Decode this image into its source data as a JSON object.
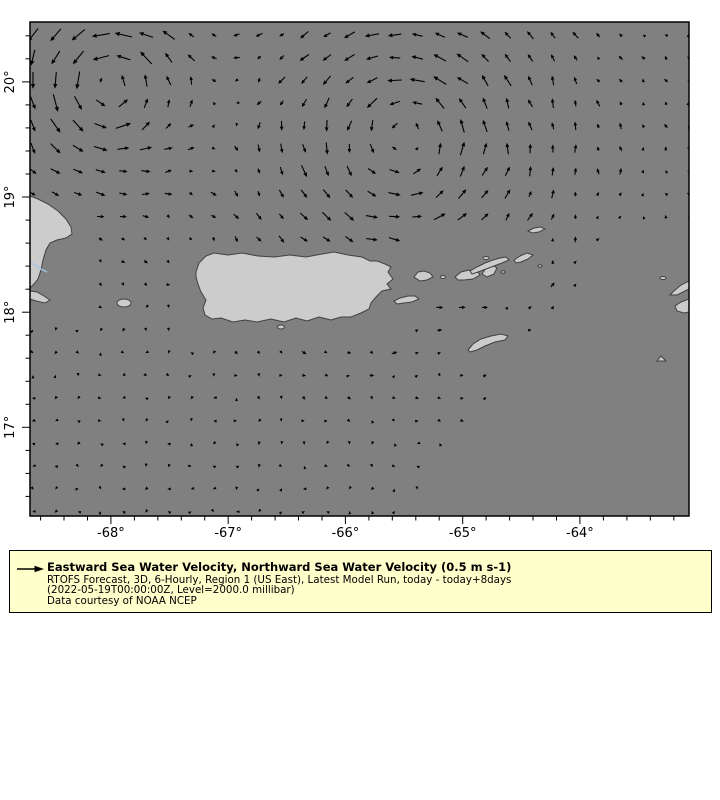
{
  "map": {
    "ocean_color": "#808080",
    "land_color": "#cccccc",
    "coast_color": "#404040",
    "river_color": "#9fc5e8",
    "arrow_color": "#000000",
    "axis_color": "#000000"
  },
  "chart_data": {
    "type": "quiver",
    "projection": "lonlat",
    "lon_range": [
      -68.69,
      -63.07
    ],
    "lat_range": [
      16.23,
      20.52
    ],
    "x_ticks": {
      "major": [
        -68,
        -67,
        -66,
        -65,
        -64
      ],
      "labels": [
        "-68°",
        "-67°",
        "-66°",
        "-65°",
        "-64°"
      ],
      "minor_step": 0.2
    },
    "y_ticks": {
      "major": [
        17,
        18,
        19,
        20
      ],
      "labels": [
        "17°",
        "18°",
        "19°",
        "20°"
      ],
      "minor_step": 0.2
    },
    "grid": {
      "origin_px": [
        33,
        35
      ],
      "dx": 22.6,
      "dy": 22.7,
      "cols": 30,
      "rows": 22
    },
    "scale_px_per_ms": 52,
    "background_flow": {
      "u": -0.022,
      "v": -0.006
    },
    "noise_amplitude": 0.045,
    "eddies": [
      {
        "center_lon": -68.05,
        "center_lat": 20.0,
        "rotation": "cyclonic",
        "peak_speed": 0.3,
        "core_radius_deg": 0.38
      },
      {
        "center_lon": -65.5,
        "center_lat": 19.55,
        "rotation": "cyclonic",
        "peak_speed": 0.24,
        "core_radius_deg": 0.6
      }
    ],
    "data_boundary": {
      "x0": 618,
      "y0": 232,
      "slope": -0.779,
      "min_y": 226
    },
    "reference_vector": {
      "speed_ms": 0.5,
      "label": "0.5 m s-1"
    }
  },
  "land": {
    "polygons": [
      {
        "name": "hispaniola-east-coast",
        "points": [
          [
            30,
            196
          ],
          [
            38,
            199
          ],
          [
            48,
            204
          ],
          [
            58,
            211
          ],
          [
            66,
            219
          ],
          [
            71,
            227
          ],
          [
            72,
            234
          ],
          [
            66,
            238
          ],
          [
            57,
            240
          ],
          [
            50,
            243
          ],
          [
            46,
            250
          ],
          [
            43,
            260
          ],
          [
            41,
            270
          ],
          [
            38,
            279
          ],
          [
            34,
            284
          ],
          [
            30,
            288
          ]
        ]
      },
      {
        "name": "hispaniola-south-peninsula",
        "points": [
          [
            30,
            291
          ],
          [
            37,
            292
          ],
          [
            44,
            296
          ],
          [
            50,
            300
          ],
          [
            45,
            303
          ],
          [
            36,
            301
          ],
          [
            30,
            299
          ]
        ]
      },
      {
        "name": "puerto-rico",
        "points": [
          [
            196,
            272
          ],
          [
            199,
            263
          ],
          [
            206,
            256
          ],
          [
            214,
            253
          ],
          [
            228,
            255
          ],
          [
            242,
            253
          ],
          [
            258,
            256
          ],
          [
            274,
            257
          ],
          [
            290,
            255
          ],
          [
            306,
            257
          ],
          [
            322,
            254
          ],
          [
            334,
            252
          ],
          [
            348,
            255
          ],
          [
            362,
            257
          ],
          [
            370,
            261
          ],
          [
            377,
            261
          ],
          [
            385,
            264
          ],
          [
            391,
            267
          ],
          [
            388,
            272
          ],
          [
            393,
            279
          ],
          [
            387,
            284
          ],
          [
            391,
            289
          ],
          [
            382,
            291
          ],
          [
            376,
            297
          ],
          [
            371,
            303
          ],
          [
            369,
            309
          ],
          [
            361,
            313
          ],
          [
            351,
            317
          ],
          [
            341,
            317
          ],
          [
            331,
            320
          ],
          [
            319,
            317
          ],
          [
            307,
            321
          ],
          [
            296,
            318
          ],
          [
            284,
            322
          ],
          [
            271,
            319
          ],
          [
            257,
            322
          ],
          [
            245,
            320
          ],
          [
            233,
            322
          ],
          [
            221,
            318
          ],
          [
            212,
            319
          ],
          [
            205,
            315
          ],
          [
            203,
            308
          ],
          [
            206,
            300
          ],
          [
            201,
            292
          ],
          [
            198,
            284
          ],
          [
            196,
            277
          ]
        ]
      },
      {
        "name": "vieques",
        "points": [
          [
            394,
            301
          ],
          [
            400,
            298
          ],
          [
            408,
            296
          ],
          [
            415,
            296
          ],
          [
            419,
            299
          ],
          [
            412,
            302
          ],
          [
            404,
            303
          ],
          [
            397,
            304
          ]
        ]
      },
      {
        "name": "culebra",
        "points": [
          [
            414,
            277
          ],
          [
            418,
            272
          ],
          [
            424,
            271
          ],
          [
            430,
            273
          ],
          [
            433,
            277
          ],
          [
            427,
            280
          ],
          [
            420,
            281
          ]
        ]
      },
      {
        "name": "st-thomas",
        "points": [
          [
            455,
            277
          ],
          [
            461,
            272
          ],
          [
            469,
            270
          ],
          [
            477,
            271
          ],
          [
            480,
            275
          ],
          [
            473,
            279
          ],
          [
            464,
            280
          ],
          [
            458,
            280
          ]
        ]
      },
      {
        "name": "st-john",
        "points": [
          [
            482,
            274
          ],
          [
            486,
            268
          ],
          [
            492,
            265
          ],
          [
            497,
            268
          ],
          [
            494,
            274
          ],
          [
            487,
            277
          ]
        ]
      },
      {
        "name": "tortola-chain",
        "points": [
          [
            470,
            271
          ],
          [
            477,
            267
          ],
          [
            485,
            263
          ],
          [
            493,
            260
          ],
          [
            500,
            258
          ],
          [
            506,
            257
          ],
          [
            509,
            260
          ],
          [
            502,
            263
          ],
          [
            494,
            266
          ],
          [
            486,
            269
          ],
          [
            478,
            272
          ],
          [
            472,
            274
          ]
        ]
      },
      {
        "name": "virgin-gorda",
        "points": [
          [
            514,
            260
          ],
          [
            520,
            256
          ],
          [
            527,
            253
          ],
          [
            533,
            255
          ],
          [
            528,
            259
          ],
          [
            521,
            262
          ],
          [
            516,
            263
          ]
        ]
      },
      {
        "name": "anegada",
        "points": [
          [
            528,
            231
          ],
          [
            534,
            228
          ],
          [
            541,
            227
          ],
          [
            545,
            229
          ],
          [
            539,
            232
          ],
          [
            532,
            233
          ]
        ]
      },
      {
        "name": "st-croix",
        "points": [
          [
            468,
            350
          ],
          [
            473,
            344
          ],
          [
            481,
            339
          ],
          [
            491,
            336
          ],
          [
            501,
            334
          ],
          [
            508,
            336
          ],
          [
            505,
            340
          ],
          [
            495,
            342
          ],
          [
            485,
            346
          ],
          [
            477,
            350
          ],
          [
            470,
            352
          ]
        ]
      },
      {
        "name": "anguilla-edge",
        "points": [
          [
            689,
            281
          ],
          [
            681,
            285
          ],
          [
            674,
            291
          ],
          [
            670,
            295
          ],
          [
            677,
            295
          ],
          [
            685,
            291
          ],
          [
            689,
            289
          ]
        ]
      },
      {
        "name": "st-martin-edge",
        "points": [
          [
            689,
            299
          ],
          [
            681,
            302
          ],
          [
            675,
            306
          ],
          [
            677,
            311
          ],
          [
            684,
            313
          ],
          [
            689,
            312
          ]
        ]
      },
      {
        "name": "saba",
        "points": [
          [
            657,
            361
          ],
          [
            661,
            356
          ],
          [
            666,
            361
          ]
        ]
      }
    ],
    "ellipses": [
      {
        "name": "mona-island",
        "cx": 124,
        "cy": 303,
        "rx": 7,
        "ry": 4
      },
      {
        "name": "caja-de-muertos",
        "cx": 281,
        "cy": 327,
        "rx": 3.5,
        "ry": 2
      },
      {
        "name": "culebrita",
        "cx": 443,
        "cy": 277,
        "rx": 2.5,
        "ry": 1.5
      },
      {
        "name": "jost-van-dyke",
        "cx": 486,
        "cy": 258,
        "rx": 3,
        "ry": 1.5
      },
      {
        "name": "islet-a",
        "cx": 503,
        "cy": 272,
        "rx": 2,
        "ry": 1.2
      },
      {
        "name": "islet-b",
        "cx": 540,
        "cy": 266,
        "rx": 2,
        "ry": 1.2
      },
      {
        "name": "dog-islands",
        "cx": 663,
        "cy": 278,
        "rx": 3,
        "ry": 1.5
      }
    ],
    "river": [
      [
        30,
        262
      ],
      [
        35,
        265
      ],
      [
        41,
        269
      ],
      [
        47,
        272
      ]
    ],
    "mask_rects": [
      [
        26,
        200,
        60,
        108
      ],
      [
        108,
        292,
        30,
        18
      ],
      [
        188,
        244,
        216,
        88
      ],
      [
        388,
        288,
        44,
        20
      ],
      [
        410,
        232,
        140,
        56
      ],
      [
        520,
        220,
        32,
        22
      ],
      [
        458,
        328,
        58,
        28
      ],
      [
        664,
        276,
        28,
        42
      ],
      [
        650,
        346,
        22,
        20
      ],
      [
        272,
        320,
        20,
        14
      ]
    ]
  },
  "legend": {
    "bg": "#ffffcc",
    "title": "Eastward Sea Water Velocity, Northward Sea Water Velocity (0.5 m s-1)",
    "line2": "RTOFS Forecast, 3D, 6-Hourly, Region 1 (US East), Latest Model Run, today - today+8days",
    "line3": "(2022-05-19T00:00:00Z, Level=2000.0 millibar)",
    "line4": "Data courtesy of NOAA NCEP"
  }
}
